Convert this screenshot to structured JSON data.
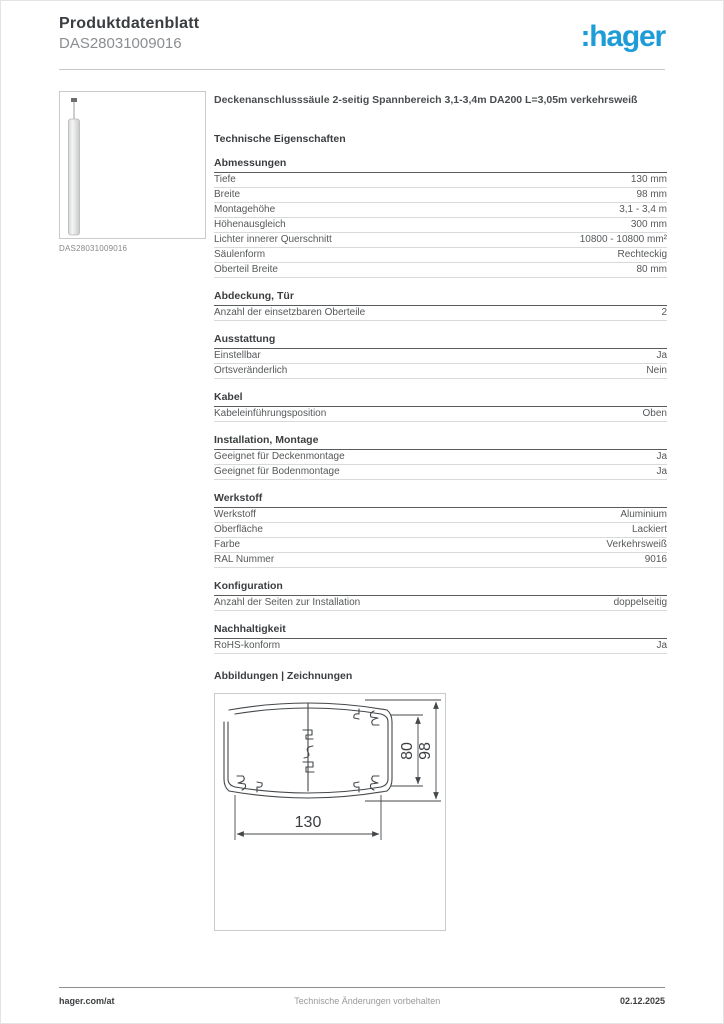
{
  "header": {
    "doc_type": "Produktdatenblatt",
    "product_id": "DAS28031009016",
    "logo": ":hager",
    "logo_color": "#1e9cd8"
  },
  "product": {
    "title": "Deckenanschlusssäule 2-seitig Spannbereich 3,1-3,4m DA200 L=3,05m verkehrsweiß",
    "image_caption": "DAS28031009016"
  },
  "tech_heading": "Technische Eigenschaften",
  "sections": [
    {
      "title": "Abmessungen",
      "rows": [
        {
          "label": "Tiefe",
          "value": "130 mm"
        },
        {
          "label": "Breite",
          "value": "98 mm"
        },
        {
          "label": "Montagehöhe",
          "value": "3,1 - 3,4 m"
        },
        {
          "label": "Höhenausgleich",
          "value": "300 mm"
        },
        {
          "label": "Lichter innerer Querschnitt",
          "value": "10800 - 10800 mm²"
        },
        {
          "label": "Säulenform",
          "value": "Rechteckig"
        },
        {
          "label": "Oberteil Breite",
          "value": "80 mm"
        }
      ]
    },
    {
      "title": "Abdeckung, Tür",
      "rows": [
        {
          "label": "Anzahl der einsetzbaren Oberteile",
          "value": "2"
        }
      ]
    },
    {
      "title": "Ausstattung",
      "rows": [
        {
          "label": "Einstellbar",
          "value": "Ja"
        },
        {
          "label": "Ortsveränderlich",
          "value": "Nein"
        }
      ]
    },
    {
      "title": "Kabel",
      "rows": [
        {
          "label": "Kabeleinführungsposition",
          "value": "Oben"
        }
      ]
    },
    {
      "title": "Installation, Montage",
      "rows": [
        {
          "label": "Geeignet für Deckenmontage",
          "value": "Ja"
        },
        {
          "label": "Geeignet für Bodenmontage",
          "value": "Ja"
        }
      ]
    },
    {
      "title": "Werkstoff",
      "rows": [
        {
          "label": "Werkstoff",
          "value": "Aluminium"
        },
        {
          "label": "Oberfläche",
          "value": "Lackiert"
        },
        {
          "label": "Farbe",
          "value": "Verkehrsweiß"
        },
        {
          "label": "RAL Nummer",
          "value": "9016"
        }
      ]
    },
    {
      "title": "Konfiguration",
      "rows": [
        {
          "label": "Anzahl der Seiten zur Installation",
          "value": "doppelseitig"
        }
      ]
    },
    {
      "title": "Nachhaltigkeit",
      "rows": [
        {
          "label": "RoHS-konform",
          "value": "Ja"
        }
      ]
    }
  ],
  "drawings": {
    "heading": "Abbildungen | Zeichnungen",
    "dimensions": {
      "width": "130",
      "inner_height": "80",
      "outer_height": "98"
    }
  },
  "footer": {
    "left": "hager.com/at",
    "center": "Technische Änderungen vorbehalten",
    "right": "02.12.2025"
  }
}
